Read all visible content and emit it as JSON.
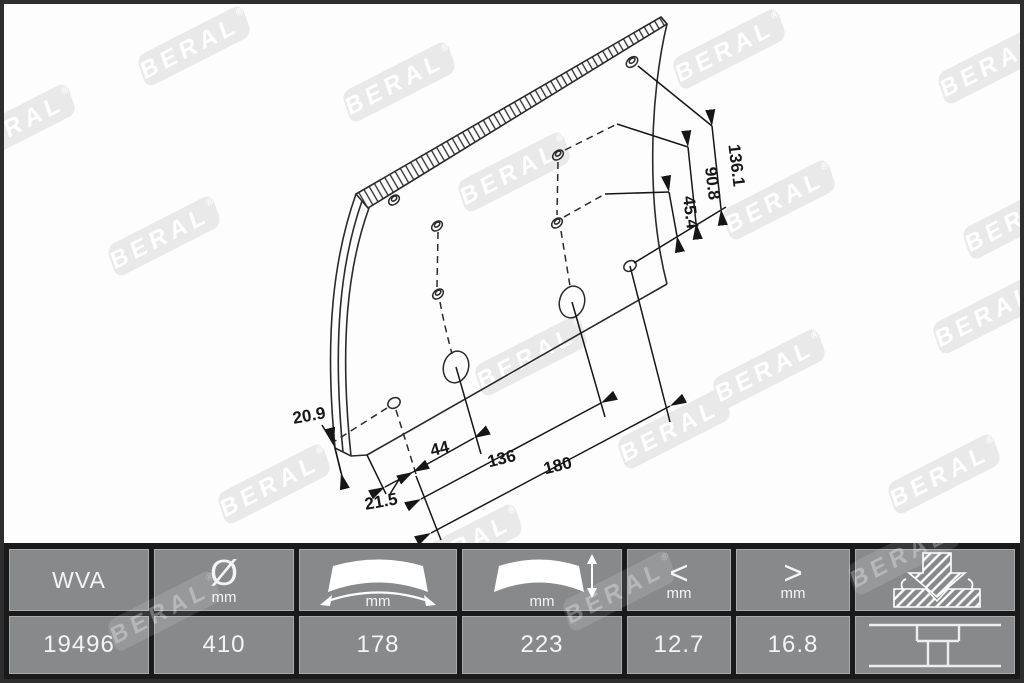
{
  "watermark": {
    "text": "BERAL",
    "registered": "®"
  },
  "drawing": {
    "dim_136_1": "136.1",
    "dim_90_8": "90.8",
    "dim_45_4": "45.4",
    "dim_20_9": "20.9",
    "dim_21_5": "21.5",
    "dim_44": "44",
    "dim_136": "136",
    "dim_180": "180"
  },
  "table": {
    "columns": [
      {
        "id": "wva",
        "header": "WVA",
        "value": "19496"
      },
      {
        "id": "diameter",
        "symbol": "Ø",
        "unit": "mm",
        "value": "410",
        "icon": "diameter-symbol"
      },
      {
        "id": "width",
        "unit": "mm",
        "value": "178",
        "icon": "lining-width-icon"
      },
      {
        "id": "thickness",
        "unit": "mm",
        "value": "223",
        "icon": "lining-thickness-icon"
      },
      {
        "id": "min",
        "symbol": "<",
        "unit": "mm",
        "value": "12.7",
        "icon": "less-than-symbol"
      },
      {
        "id": "max",
        "symbol": ">",
        "unit": "mm",
        "value": "16.8",
        "icon": "greater-than-symbol"
      },
      {
        "id": "mounting",
        "header_icon": "grinding-icon",
        "value_icon": "rivet-section-icon"
      }
    ]
  },
  "colors": {
    "line": "#2a2a2a",
    "cell_gray": "#87898b",
    "table_bg": "#1a1a1a",
    "watermark_gray": "#e9e9e9",
    "text_light": "#f4f4f4"
  }
}
